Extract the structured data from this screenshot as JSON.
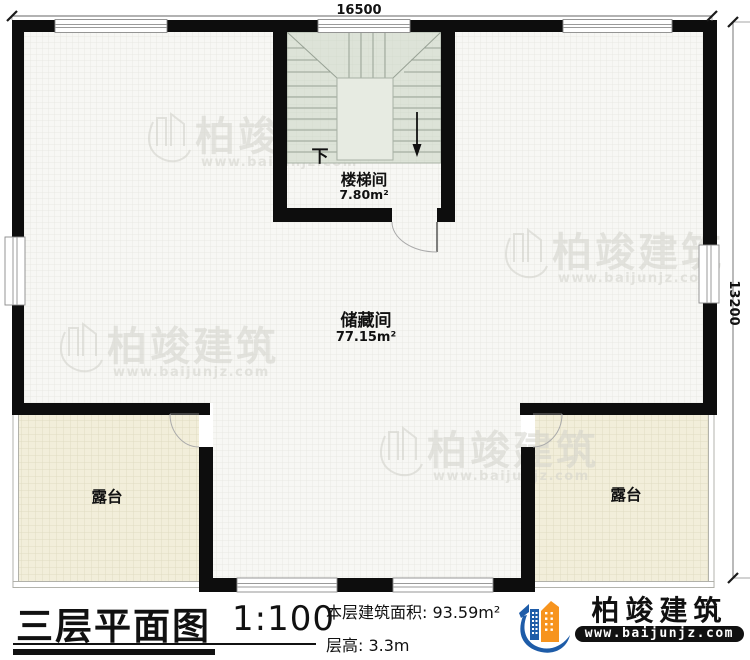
{
  "plan": {
    "dim_top": "16500",
    "dim_right": "13200",
    "stairwell": {
      "label": "楼梯间",
      "area": "7.80m²",
      "down": "下"
    },
    "storage": {
      "label": "储藏间",
      "area": "77.15m²"
    },
    "terrace_left": {
      "label": "露台"
    },
    "terrace_right": {
      "label": "露台"
    }
  },
  "watermark": {
    "company": "柏竣建筑",
    "website": "www.baijunjz.com"
  },
  "title_block": {
    "title": "三层平面图",
    "scale": "1:100",
    "area": "本层建筑面积: 93.59m²",
    "floor_height": "层高: 3.3m"
  },
  "branding": {
    "company": "柏竣建筑",
    "website": "www.baijunjz.com",
    "orange": "#F7941E",
    "blue": "#1E5CA8"
  }
}
